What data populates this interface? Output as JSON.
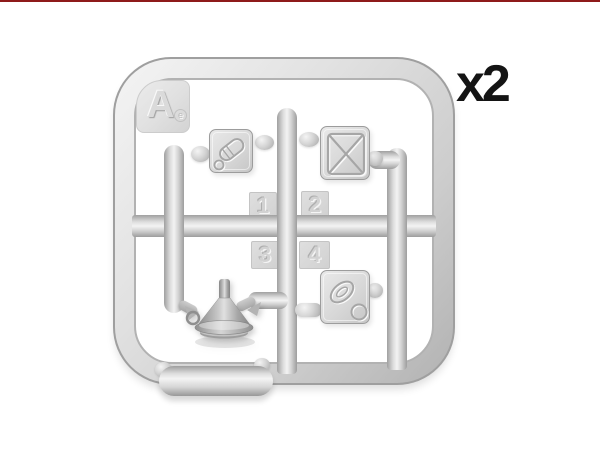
{
  "page": {
    "background_color": "#ffffff",
    "top_rule_color": "#8e1a1a",
    "quantity_label": "x2"
  },
  "sprue": {
    "letter": "A",
    "mold_mark": "e",
    "part_numbers": [
      "1",
      "2",
      "3",
      "4"
    ],
    "parts": [
      {
        "number": "1",
        "icon": "jerry-can-cap-plate-icon",
        "position": "top-left"
      },
      {
        "number": "2",
        "icon": "jerry-can-x-panel-plate-icon",
        "position": "top-right"
      },
      {
        "number": "3",
        "icon": "funnel-icon",
        "position": "bottom-left"
      },
      {
        "number": "4",
        "icon": "jerry-can-handle-plate-icon",
        "position": "bottom-right"
      }
    ],
    "extra_parts": [
      "moulded-capsule-on-bottom-rail"
    ],
    "plastic_colors": {
      "highlight": "#f4f4f4",
      "light": "#dedede",
      "mid": "#c9c9c9",
      "dark": "#9f9f9f"
    },
    "label_color": "#141414"
  }
}
